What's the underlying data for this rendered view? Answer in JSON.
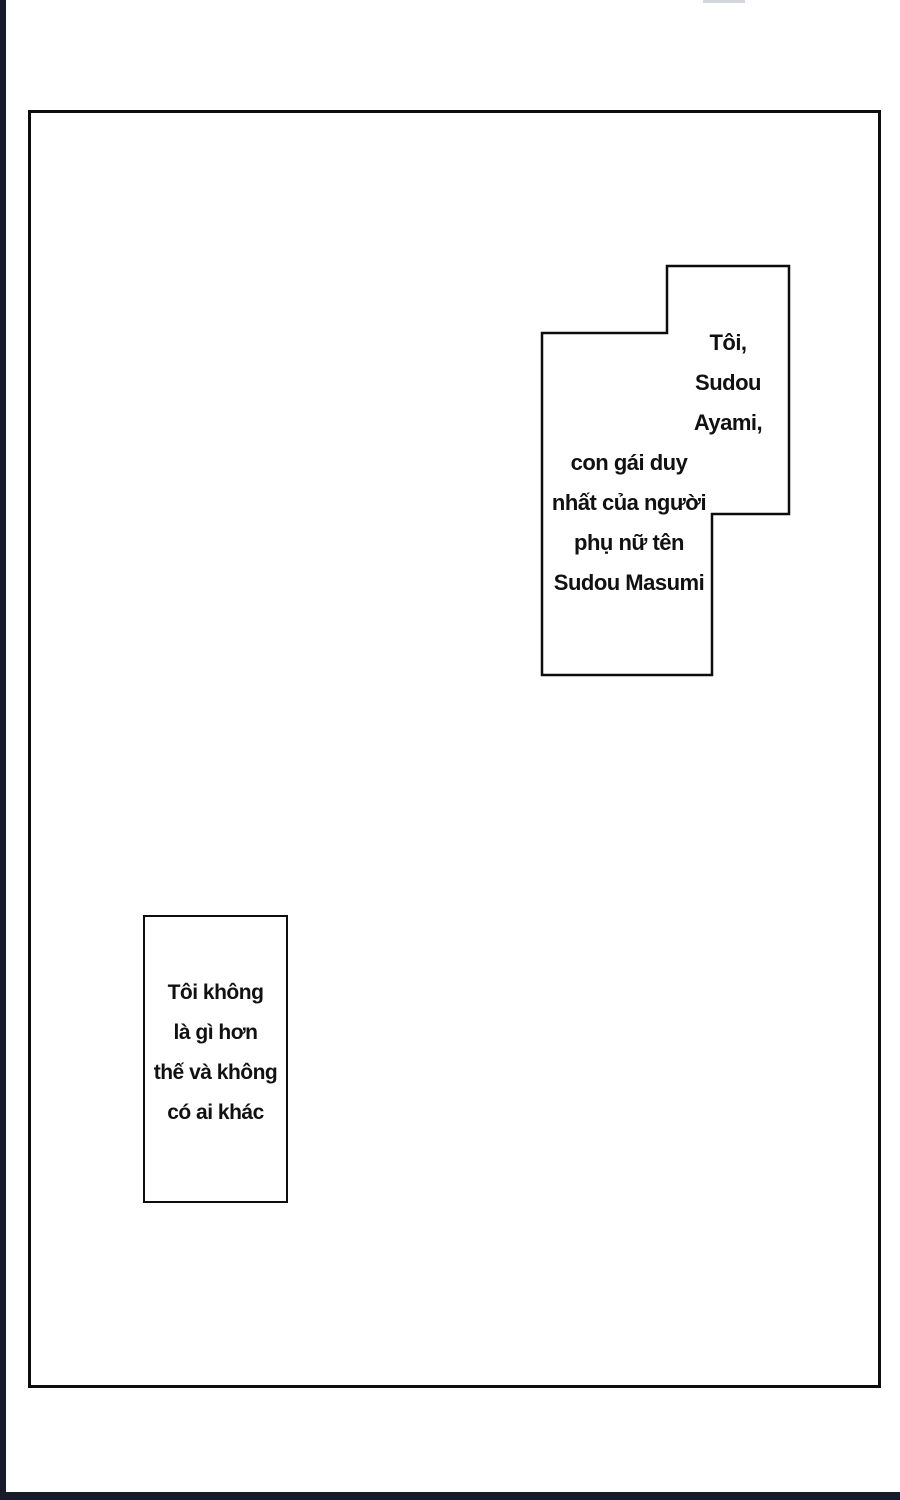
{
  "page": {
    "background_color": "#ffffff",
    "edge_strip_color": "#171b2c",
    "panel_border_color": "#0d0d0d",
    "text_color": "#111111"
  },
  "balloon_top_right": {
    "right_lines": [
      "Tôi,",
      "Sudou",
      "Ayami,"
    ],
    "left_lines": [
      "con gái duy",
      "nhất của người",
      "phụ nữ tên",
      "Sudou Masumi"
    ]
  },
  "balloon_bottom_left": {
    "lines": [
      "Tôi không",
      "là gì hơn",
      "thế và không",
      "có ai khác"
    ]
  }
}
